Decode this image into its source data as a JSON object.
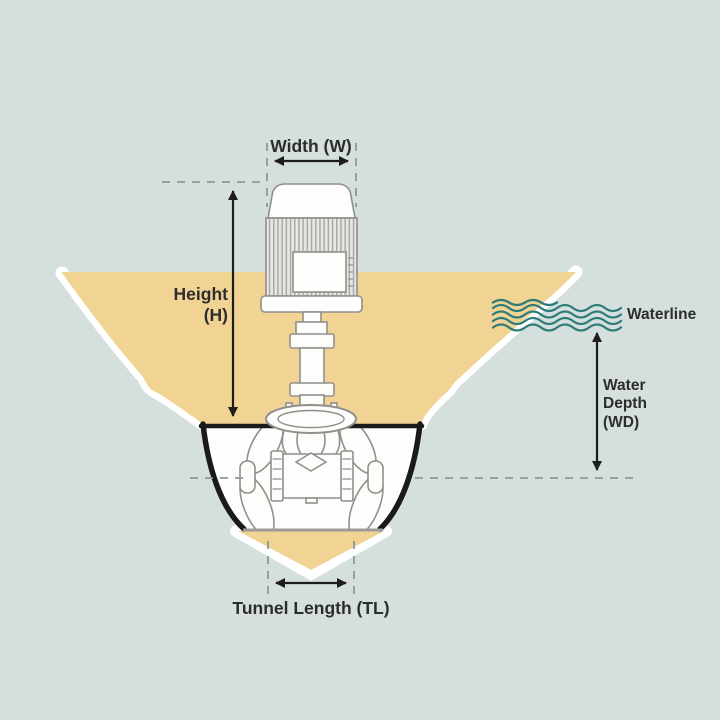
{
  "labels": {
    "width": "Width (W)",
    "height": "Height\n(H)",
    "waterline": "Waterline",
    "water_depth": "Water\nDepth\n(WD)",
    "tunnel_length": "Tunnel Length (TL)"
  },
  "colors": {
    "background": "#d4dfde",
    "hull_fill": "#f1d494",
    "plating": "#ffffff",
    "outline_black": "#1a1a18",
    "machinery_stroke": "#8f8f8c",
    "machinery_fill": "#fdfdfb",
    "motor_body_fill": "#e7e7e5",
    "fin_stripe": "#a9a9a6",
    "tunnel_bottom_line": "#9b9b99",
    "dashed_guide": "#8c9997",
    "dimension_line": "#1d1d1b",
    "wave": "#2d7c79",
    "text": "#2d2d2d"
  }
}
